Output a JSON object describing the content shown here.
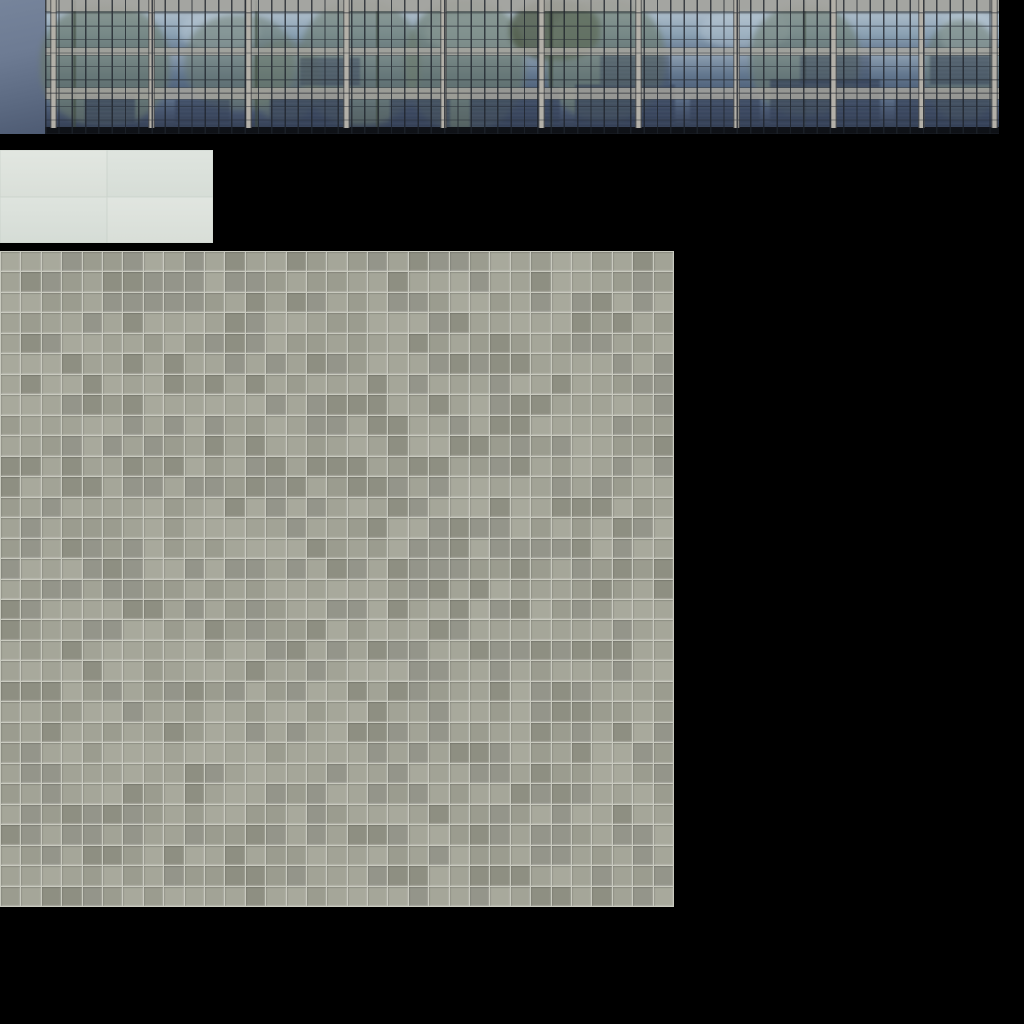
{
  "canvas": {
    "width": 1024,
    "height": 1024
  },
  "palette": {
    "background": "#000000",
    "glass_top": "#a7b8c6",
    "glass_mid": "#64788f",
    "glass_deep": "#3a465c",
    "mullion": "#1e232b",
    "pillar": "#b3b0a8",
    "spandrel": "#a7a6a0",
    "side_top": "#76849b",
    "side_bottom": "#4e5b73",
    "sky": "#bccbd7",
    "tree": "#6b7a6b",
    "tree_dark": "#49543f",
    "trunk": "#3f4a3d",
    "tower": "#2c3850",
    "plaster": "#dde3dc",
    "grout": "#c9cabf"
  },
  "atlas": {
    "sheet_name": "building-texture-atlas",
    "regions": {
      "facade": {
        "label": "glass-curtain-wall-facade-strip",
        "x": 0,
        "y": 0,
        "w": 999,
        "h": 134,
        "side_width": 45,
        "pillars_x": [
          50,
          148,
          245,
          343,
          440,
          538,
          635,
          733,
          830,
          918,
          991
        ],
        "blobs": [
          {
            "t": "sky",
            "x": 180,
            "y": 12,
            "w": 80,
            "h": 38,
            "o": 0.45
          },
          {
            "t": "sky",
            "x": 425,
            "y": 12,
            "w": 140,
            "h": 42,
            "o": 0.5
          },
          {
            "t": "sky",
            "x": 700,
            "y": 12,
            "w": 90,
            "h": 36,
            "o": 0.4
          },
          {
            "t": "sky",
            "x": 940,
            "y": 12,
            "w": 58,
            "h": 44,
            "o": 0.5
          },
          {
            "t": "tree",
            "x": 40,
            "y": 5,
            "w": 130,
            "h": 120,
            "o": 0.6
          },
          {
            "t": "tree",
            "x": 185,
            "y": 15,
            "w": 110,
            "h": 95,
            "o": 0.5
          },
          {
            "t": "tree",
            "x": 250,
            "y": 40,
            "w": 70,
            "h": 80,
            "o": 0.45
          },
          {
            "t": "tree",
            "x": 300,
            "y": 0,
            "w": 120,
            "h": 125,
            "o": 0.55
          },
          {
            "t": "tree",
            "x": 405,
            "y": 0,
            "w": 120,
            "h": 130,
            "o": 0.6
          },
          {
            "t": "tree_dark",
            "x": 510,
            "y": 0,
            "w": 90,
            "h": 60,
            "o": 0.75
          },
          {
            "t": "tree",
            "x": 545,
            "y": 0,
            "w": 120,
            "h": 120,
            "o": 0.6
          },
          {
            "t": "tree",
            "x": 750,
            "y": 5,
            "w": 110,
            "h": 110,
            "o": 0.55
          },
          {
            "t": "tree",
            "x": 925,
            "y": 20,
            "w": 75,
            "h": 100,
            "o": 0.5
          },
          {
            "t": "trunk",
            "x": 73,
            "y": 0,
            "w": 3,
            "h": 130,
            "o": 0.6
          },
          {
            "t": "trunk",
            "x": 255,
            "y": 0,
            "w": 3,
            "h": 130,
            "o": 0.6
          },
          {
            "t": "trunk",
            "x": 376,
            "y": 0,
            "w": 3,
            "h": 130,
            "o": 0.6
          },
          {
            "t": "trunk",
            "x": 549,
            "y": 0,
            "w": 4,
            "h": 130,
            "o": 0.65
          },
          {
            "t": "trunk",
            "x": 803,
            "y": 0,
            "w": 3,
            "h": 130,
            "o": 0.55
          },
          {
            "t": "tower",
            "x": 85,
            "y": 95,
            "w": 50,
            "h": 33,
            "o": 0.65
          },
          {
            "t": "tower",
            "x": 175,
            "y": 100,
            "w": 55,
            "h": 28,
            "o": 0.6
          },
          {
            "t": "tower",
            "x": 270,
            "y": 90,
            "w": 80,
            "h": 38,
            "o": 0.7
          },
          {
            "t": "tower",
            "x": 390,
            "y": 98,
            "w": 60,
            "h": 30,
            "o": 0.65
          },
          {
            "t": "tower",
            "x": 470,
            "y": 88,
            "w": 90,
            "h": 40,
            "o": 0.7
          },
          {
            "t": "tower",
            "x": 575,
            "y": 85,
            "w": 100,
            "h": 43,
            "o": 0.7
          },
          {
            "t": "tower",
            "x": 690,
            "y": 95,
            "w": 70,
            "h": 33,
            "o": 0.65
          },
          {
            "t": "tower",
            "x": 770,
            "y": 80,
            "w": 110,
            "h": 48,
            "o": 0.7
          },
          {
            "t": "tower",
            "x": 895,
            "y": 90,
            "w": 95,
            "h": 38,
            "o": 0.68
          },
          {
            "t": "tower",
            "x": 300,
            "y": 58,
            "w": 60,
            "h": 28,
            "o": 0.45
          },
          {
            "t": "tower",
            "x": 600,
            "y": 55,
            "w": 70,
            "h": 30,
            "o": 0.4
          },
          {
            "t": "tower",
            "x": 800,
            "y": 55,
            "w": 70,
            "h": 30,
            "o": 0.45
          },
          {
            "t": "tower",
            "x": 930,
            "y": 55,
            "w": 60,
            "h": 30,
            "o": 0.5
          }
        ]
      },
      "plaster": {
        "label": "plaster-wall-panel",
        "x": 0,
        "y": 150,
        "w": 213,
        "h": 93,
        "quadrant_colors": [
          "#e0e5df",
          "#dde3dd",
          "#dce2dc",
          "#dfe4de"
        ]
      },
      "tiles": {
        "label": "ceramic-tile-floor",
        "x": 0,
        "y": 251,
        "w": 674,
        "h": 656,
        "cols": 33,
        "rows": 32,
        "shades": [
          "#a8a99c",
          "#a2a396",
          "#9b9c8f",
          "#94958a",
          "#8e8f82",
          "#a5a699"
        ]
      }
    }
  }
}
